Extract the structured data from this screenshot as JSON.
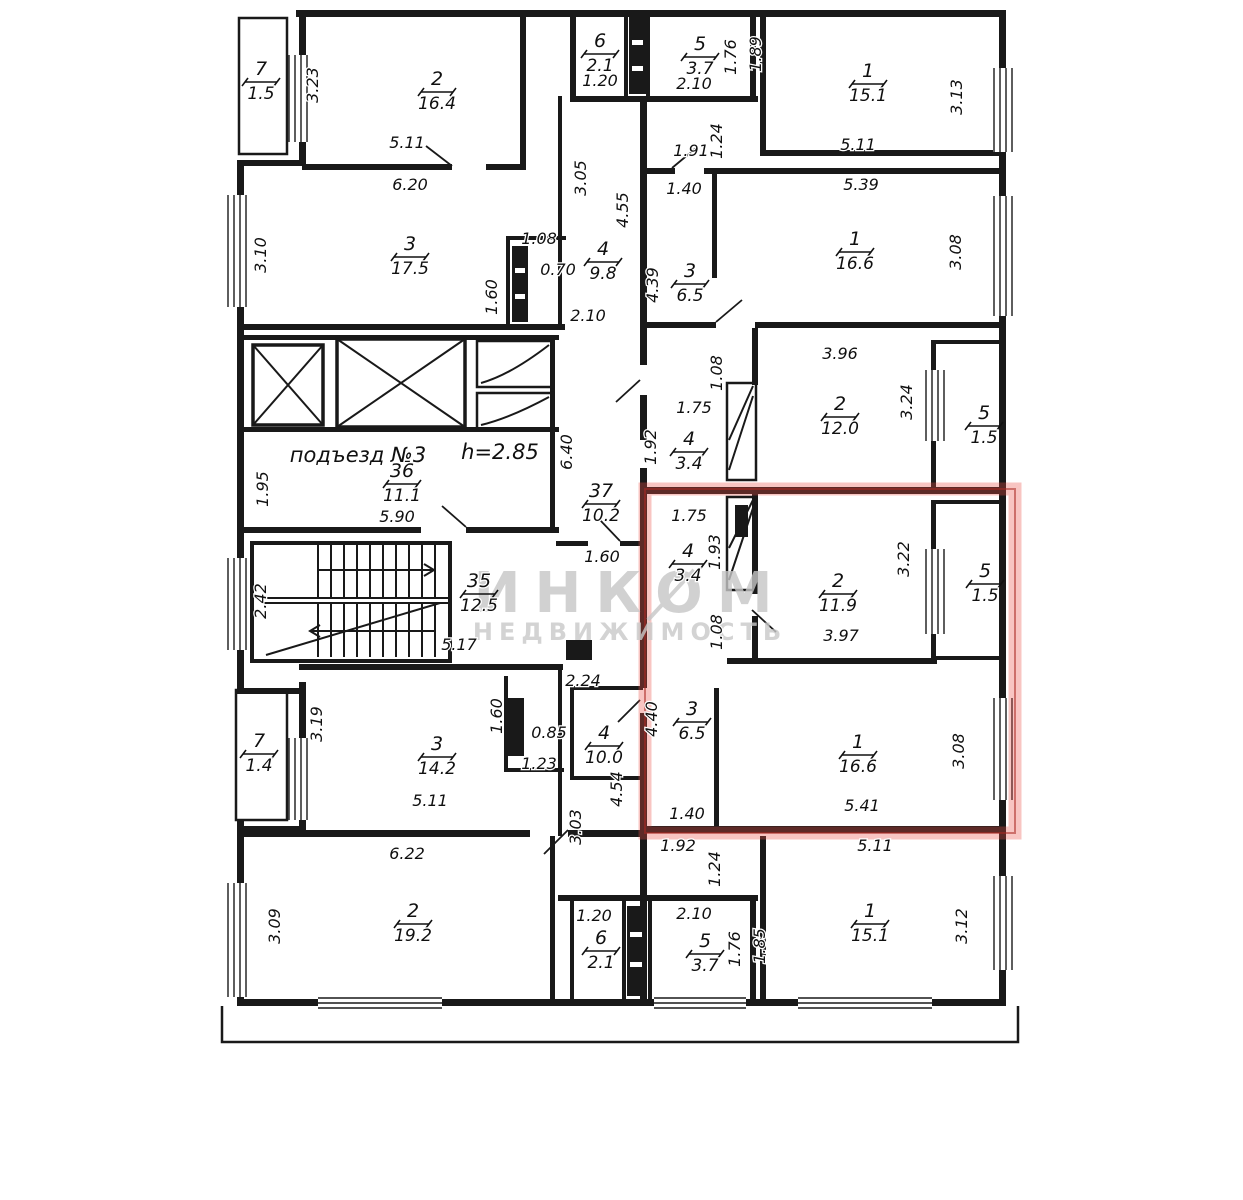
{
  "plan": {
    "entrance_label": "подъезд №3",
    "ceiling_height_label": "h=2.85",
    "watermark": {
      "line1": "ИНКОМ",
      "line2": "НЕДВИЖИМОСТЬ"
    },
    "colors": {
      "walls": "#191919",
      "highlight": "#e8564a",
      "watermark": "#c6c6c6"
    }
  },
  "rooms": [
    {
      "number": "7",
      "area": "1.5",
      "x": 261,
      "y": 80
    },
    {
      "number": "2",
      "area": "16.4",
      "x": 437,
      "y": 90
    },
    {
      "number": "6",
      "area": "2.1",
      "x": 600,
      "y": 52
    },
    {
      "number": "5",
      "area": "3.7",
      "x": 700,
      "y": 55
    },
    {
      "number": "1",
      "area": "15.1",
      "x": 868,
      "y": 82
    },
    {
      "number": "3",
      "area": "17.5",
      "x": 410,
      "y": 255
    },
    {
      "number": "4",
      "area": "9.8",
      "x": 603,
      "y": 260
    },
    {
      "number": "3",
      "area": "6.5",
      "x": 690,
      "y": 282
    },
    {
      "number": "1",
      "area": "16.6",
      "x": 855,
      "y": 250
    },
    {
      "number": "2",
      "area": "12.0",
      "x": 840,
      "y": 415
    },
    {
      "number": "5",
      "area": "1.5",
      "x": 984,
      "y": 424
    },
    {
      "number": "4",
      "area": "3.4",
      "x": 689,
      "y": 450
    },
    {
      "number": "36",
      "area": "11.1",
      "x": 402,
      "y": 482
    },
    {
      "number": "37",
      "area": "10.2",
      "x": 601,
      "y": 502
    },
    {
      "number": "35",
      "area": "12.5",
      "x": 479,
      "y": 592
    },
    {
      "number": "4",
      "area": "3.4",
      "x": 688,
      "y": 562
    },
    {
      "number": "2",
      "area": "11.9",
      "x": 838,
      "y": 592
    },
    {
      "number": "5",
      "area": "1.5",
      "x": 985,
      "y": 582
    },
    {
      "number": "3",
      "area": "6.5",
      "x": 692,
      "y": 720
    },
    {
      "number": "1",
      "area": "16.6",
      "x": 858,
      "y": 753
    },
    {
      "number": "3",
      "area": "14.2",
      "x": 437,
      "y": 755
    },
    {
      "number": "7",
      "area": "1.4",
      "x": 259,
      "y": 752
    },
    {
      "number": "4",
      "area": "10.0",
      "x": 604,
      "y": 744
    },
    {
      "number": "2",
      "area": "19.2",
      "x": 413,
      "y": 922
    },
    {
      "number": "6",
      "area": "2.1",
      "x": 601,
      "y": 949
    },
    {
      "number": "5",
      "area": "3.7",
      "x": 705,
      "y": 952
    },
    {
      "number": "1",
      "area": "15.1",
      "x": 870,
      "y": 922
    }
  ],
  "dimensions": [
    {
      "value": "3.23",
      "x": 318,
      "y": 85,
      "vertical": true
    },
    {
      "value": "5.11",
      "x": 407,
      "y": 148,
      "vertical": false
    },
    {
      "value": "6.20",
      "x": 410,
      "y": 190,
      "vertical": false
    },
    {
      "value": "1.20",
      "x": 600,
      "y": 86,
      "vertical": false
    },
    {
      "value": "2.10",
      "x": 694,
      "y": 89,
      "vertical": false
    },
    {
      "value": "1.76",
      "x": 736,
      "y": 57,
      "vertical": true
    },
    {
      "value": "1.89",
      "x": 761,
      "y": 54,
      "vertical": true
    },
    {
      "value": "5.11",
      "x": 858,
      "y": 150,
      "vertical": false
    },
    {
      "value": "3.13",
      "x": 962,
      "y": 97,
      "vertical": true
    },
    {
      "value": "1.91",
      "x": 691,
      "y": 156,
      "vertical": false
    },
    {
      "value": "1.24",
      "x": 722,
      "y": 141,
      "vertical": true
    },
    {
      "value": "3.05",
      "x": 586,
      "y": 178,
      "vertical": true
    },
    {
      "value": "1.40",
      "x": 684,
      "y": 194,
      "vertical": false
    },
    {
      "value": "4.55",
      "x": 628,
      "y": 210,
      "vertical": true
    },
    {
      "value": "5.39",
      "x": 861,
      "y": 190,
      "vertical": false
    },
    {
      "value": "3.10",
      "x": 266,
      "y": 255,
      "vertical": true
    },
    {
      "value": "1.08",
      "x": 539,
      "y": 244,
      "vertical": false
    },
    {
      "value": "0.70",
      "x": 558,
      "y": 275,
      "vertical": false
    },
    {
      "value": "1.60",
      "x": 497,
      "y": 297,
      "vertical": true
    },
    {
      "value": "2.10",
      "x": 588,
      "y": 321,
      "vertical": false
    },
    {
      "value": "4.39",
      "x": 658,
      "y": 285,
      "vertical": true
    },
    {
      "value": "3.08",
      "x": 961,
      "y": 252,
      "vertical": true
    },
    {
      "value": "3.96",
      "x": 840,
      "y": 359,
      "vertical": false
    },
    {
      "value": "1.75",
      "x": 694,
      "y": 413,
      "vertical": false
    },
    {
      "value": "1.92",
      "x": 656,
      "y": 447,
      "vertical": true
    },
    {
      "value": "1.08",
      "x": 722,
      "y": 373,
      "vertical": true
    },
    {
      "value": "3.24",
      "x": 912,
      "y": 402,
      "vertical": true
    },
    {
      "value": "6.40",
      "x": 572,
      "y": 452,
      "vertical": true
    },
    {
      "value": "1.95",
      "x": 268,
      "y": 489,
      "vertical": true
    },
    {
      "value": "5.90",
      "x": 397,
      "y": 522,
      "vertical": false
    },
    {
      "value": "2.42",
      "x": 266,
      "y": 601,
      "vertical": true
    },
    {
      "value": "5.17",
      "x": 459,
      "y": 650,
      "vertical": false
    },
    {
      "value": "1.60",
      "x": 602,
      "y": 562,
      "vertical": false
    },
    {
      "value": "2.24",
      "x": 583,
      "y": 686,
      "vertical": false
    },
    {
      "value": "1.75",
      "x": 689,
      "y": 521,
      "vertical": false
    },
    {
      "value": "1.93",
      "x": 720,
      "y": 552,
      "vertical": true
    },
    {
      "value": "1.08",
      "x": 722,
      "y": 632,
      "vertical": true
    },
    {
      "value": "3.97",
      "x": 841,
      "y": 641,
      "vertical": false
    },
    {
      "value": "3.22",
      "x": 909,
      "y": 559,
      "vertical": true
    },
    {
      "value": "4.40",
      "x": 657,
      "y": 719,
      "vertical": true
    },
    {
      "value": "1.40",
      "x": 687,
      "y": 819,
      "vertical": false
    },
    {
      "value": "3.08",
      "x": 964,
      "y": 751,
      "vertical": true
    },
    {
      "value": "5.41",
      "x": 862,
      "y": 811,
      "vertical": false
    },
    {
      "value": "1.92",
      "x": 678,
      "y": 851,
      "vertical": false
    },
    {
      "value": "5.11",
      "x": 875,
      "y": 851,
      "vertical": false
    },
    {
      "value": "1.24",
      "x": 720,
      "y": 869,
      "vertical": true
    },
    {
      "value": "4.54",
      "x": 622,
      "y": 789,
      "vertical": true
    },
    {
      "value": "3.19",
      "x": 322,
      "y": 724,
      "vertical": true
    },
    {
      "value": "1.60",
      "x": 502,
      "y": 716,
      "vertical": true
    },
    {
      "value": "0.85",
      "x": 549,
      "y": 738,
      "vertical": false
    },
    {
      "value": "1.23",
      "x": 539,
      "y": 769,
      "vertical": false
    },
    {
      "value": "3.03",
      "x": 581,
      "y": 827,
      "vertical": true
    },
    {
      "value": "5.11",
      "x": 430,
      "y": 806,
      "vertical": false
    },
    {
      "value": "6.22",
      "x": 407,
      "y": 859,
      "vertical": false
    },
    {
      "value": "3.09",
      "x": 280,
      "y": 926,
      "vertical": true
    },
    {
      "value": "1.20",
      "x": 594,
      "y": 921,
      "vertical": false
    },
    {
      "value": "2.10",
      "x": 694,
      "y": 919,
      "vertical": false
    },
    {
      "value": "1.76",
      "x": 740,
      "y": 949,
      "vertical": true
    },
    {
      "value": "1.85",
      "x": 765,
      "y": 946,
      "vertical": true
    },
    {
      "value": "3.12",
      "x": 967,
      "y": 926,
      "vertical": true
    }
  ]
}
